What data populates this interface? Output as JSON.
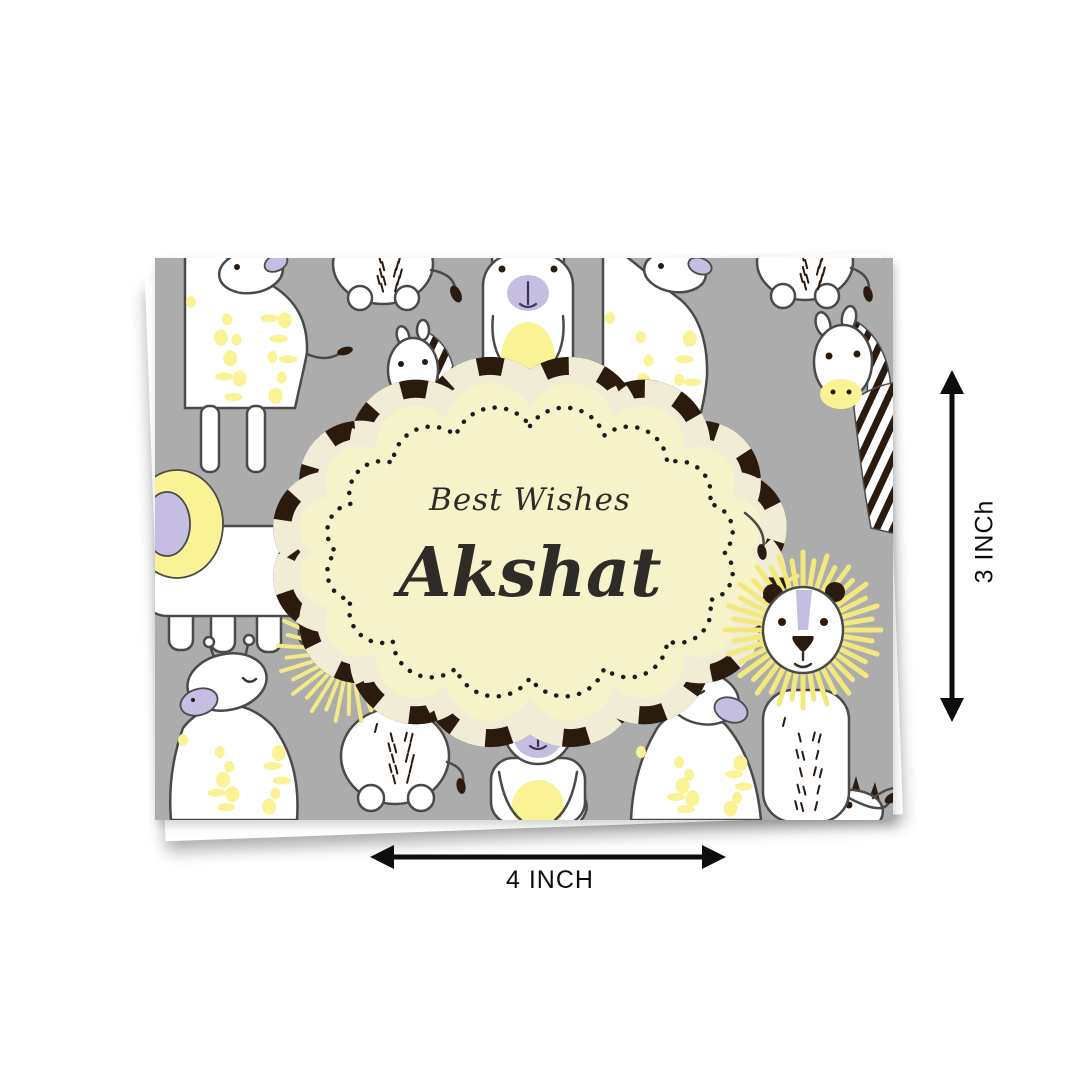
{
  "card": {
    "greeting_line": "Best Wishes",
    "name": "Akshat",
    "background_color": "#ACACAC",
    "frame_fill": "#F6F3CB",
    "palette": {
      "accent_yellow": "#FAF396",
      "accent_purple": "#C6BDE3",
      "stripe_dark": "#2B1B0F",
      "frame_cream": "#F1ECD6",
      "outline_gray": "#4A4A4A"
    },
    "pattern_animals": [
      "giraffe",
      "bear",
      "zebra",
      "lion",
      "elephant"
    ]
  },
  "dimensions": {
    "width_label": "4 INCH",
    "height_label": "3 INCh",
    "arrow_color": "#0d0d0d"
  }
}
